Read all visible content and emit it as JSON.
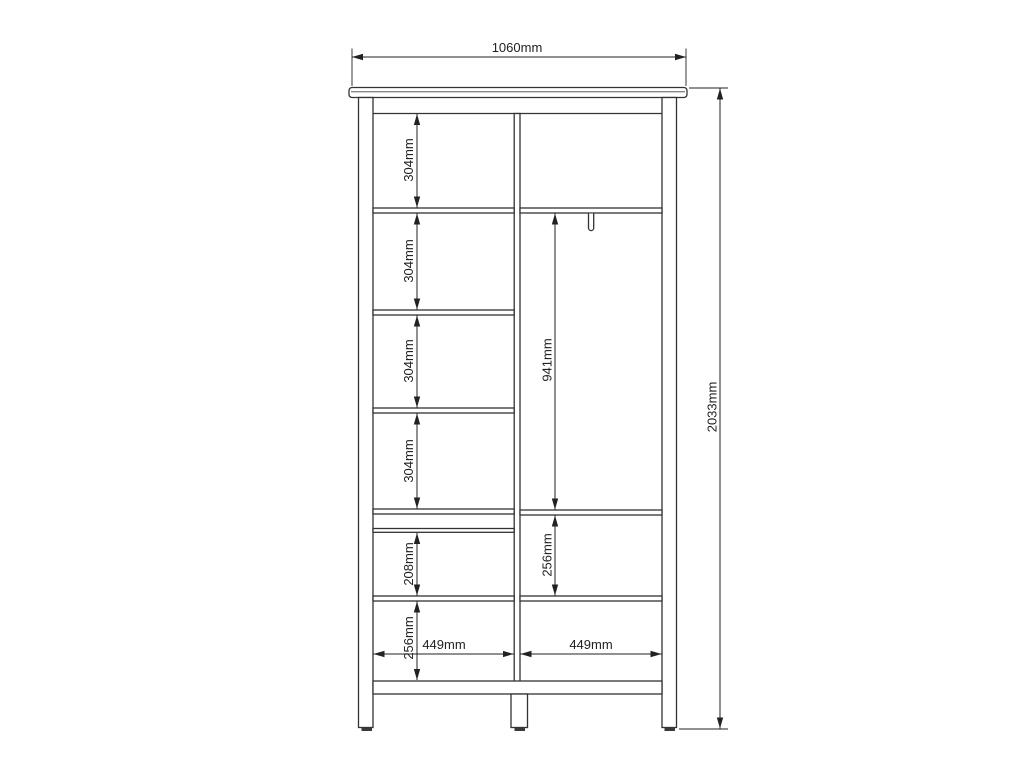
{
  "colors": {
    "background": "#ffffff",
    "structure_line": "#333333",
    "dimension_line": "#222222",
    "feet": "#3a3a3a"
  },
  "drawing": {
    "name": "wardrobe-front-elevation-dimension-drawing",
    "overall_width": "1060mm",
    "overall_height": "2033mm",
    "left_sections": [
      "304mm",
      "304mm",
      "304mm",
      "304mm",
      "208mm",
      "256mm"
    ],
    "hanging_height": "941mm",
    "hanging_lower": "256mm",
    "compartment_width_left": "449mm",
    "compartment_width_right": "449mm"
  }
}
